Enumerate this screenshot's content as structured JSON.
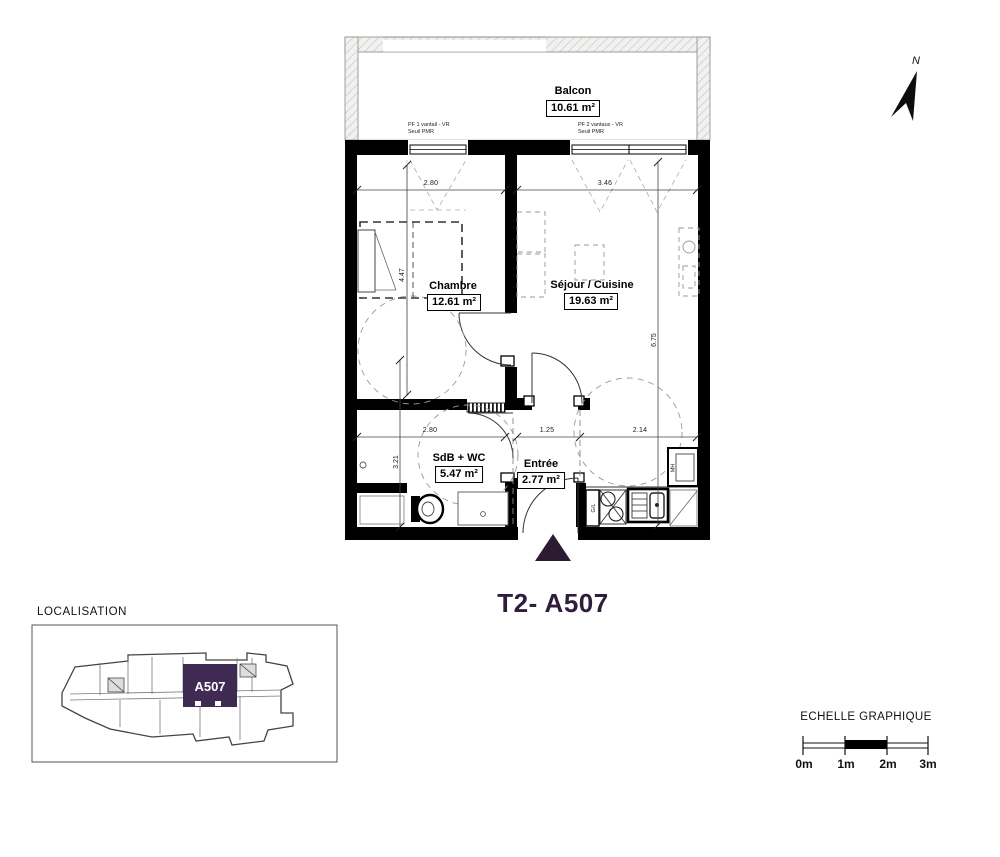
{
  "colors": {
    "accent": "#3E2A52",
    "title_purple": "#2F1D3D",
    "triangle": "#2B1C33"
  },
  "plan": {
    "title": "T2- A507",
    "north_label": "N",
    "rooms": {
      "balcon": {
        "name": "Balcon",
        "area": "10.61 m²"
      },
      "chambre": {
        "name": "Chambre",
        "area": "12.61 m²"
      },
      "sejour": {
        "name": "Séjour / Cuisine",
        "area": "19.63 m²"
      },
      "sdb": {
        "name": "SdB + WC",
        "area": "5.47 m²"
      },
      "entree": {
        "name": "Entrée",
        "area": "2.77 m²"
      }
    },
    "window_labels": {
      "pf1_line1": "PF 1 vantail - VR",
      "pf1_line2": "Seuil PMR",
      "pf2_line1": "PF 2 vantaux - VR",
      "pf2_line2": "Seuil PMR"
    },
    "dimensions": {
      "chambre_width": "2.80",
      "sejour_width": "3.46",
      "chambre_height": "4.47",
      "sejour_height": "6.75",
      "sdb_width": "2.80",
      "entree_width": "1.25",
      "kitchen_width": "2.14",
      "sdb_height": "3.21"
    },
    "fixtures": {
      "washer": "G/L",
      "mh": "MH"
    }
  },
  "localisation": {
    "label": "LOCALISATION",
    "unit": "A507"
  },
  "scale_bar": {
    "title": "ECHELLE GRAPHIQUE",
    "ticks": [
      "0m",
      "1m",
      "2m",
      "3m"
    ]
  }
}
